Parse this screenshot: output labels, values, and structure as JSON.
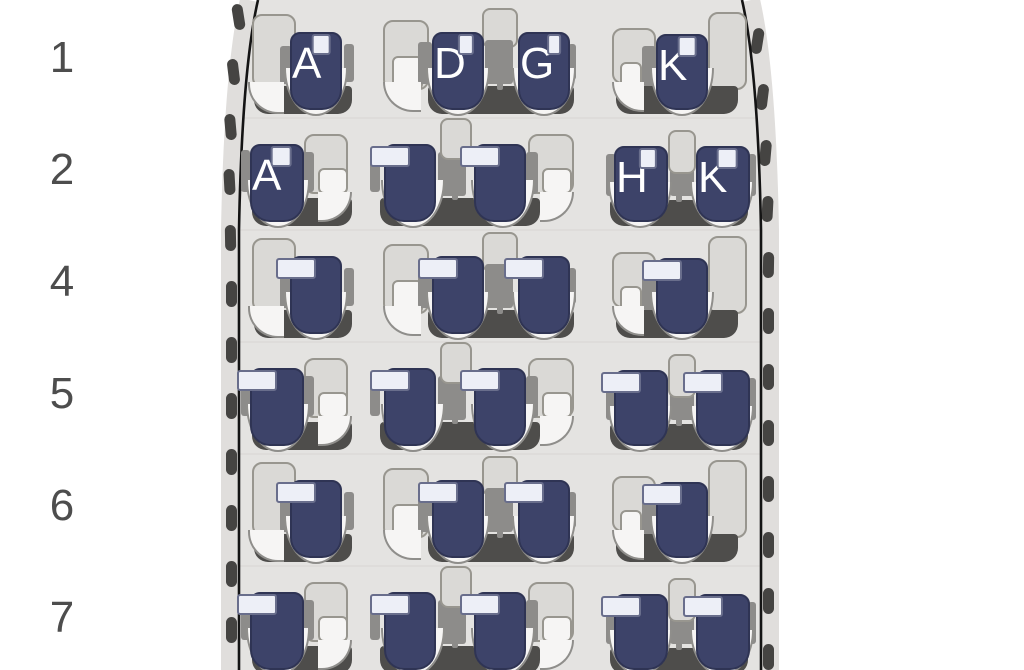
{
  "cabin": {
    "class_label": "Business",
    "accent_color": "#2f5f99",
    "seat_color": "#3d4369",
    "seat_letter_color": "#ffffff",
    "row_label_color": "#4d4d4d"
  },
  "seatmap": {
    "rows": [
      {
        "number": "1",
        "type": "A",
        "seats": {
          "left": [
            "A"
          ],
          "center": [
            "D",
            "G"
          ],
          "right": [
            "K"
          ]
        }
      },
      {
        "number": "2",
        "type": "B",
        "seats": {
          "left": [
            "A"
          ],
          "center": [
            "",
            ""
          ],
          "right": [
            "H",
            "K"
          ]
        }
      },
      {
        "number": "4",
        "type": "A",
        "seats": {
          "left": [
            ""
          ],
          "center": [
            "",
            ""
          ],
          "right": [
            ""
          ]
        }
      },
      {
        "number": "5",
        "type": "B",
        "seats": {
          "left": [
            ""
          ],
          "center": [
            "",
            ""
          ],
          "right": [
            "",
            ""
          ]
        }
      },
      {
        "number": "6",
        "type": "A",
        "seats": {
          "left": [
            ""
          ],
          "center": [
            "",
            ""
          ],
          "right": [
            ""
          ]
        }
      },
      {
        "number": "7",
        "type": "B",
        "seats": {
          "left": [
            ""
          ],
          "center": [
            "",
            ""
          ],
          "right": [
            "",
            ""
          ]
        }
      }
    ]
  }
}
